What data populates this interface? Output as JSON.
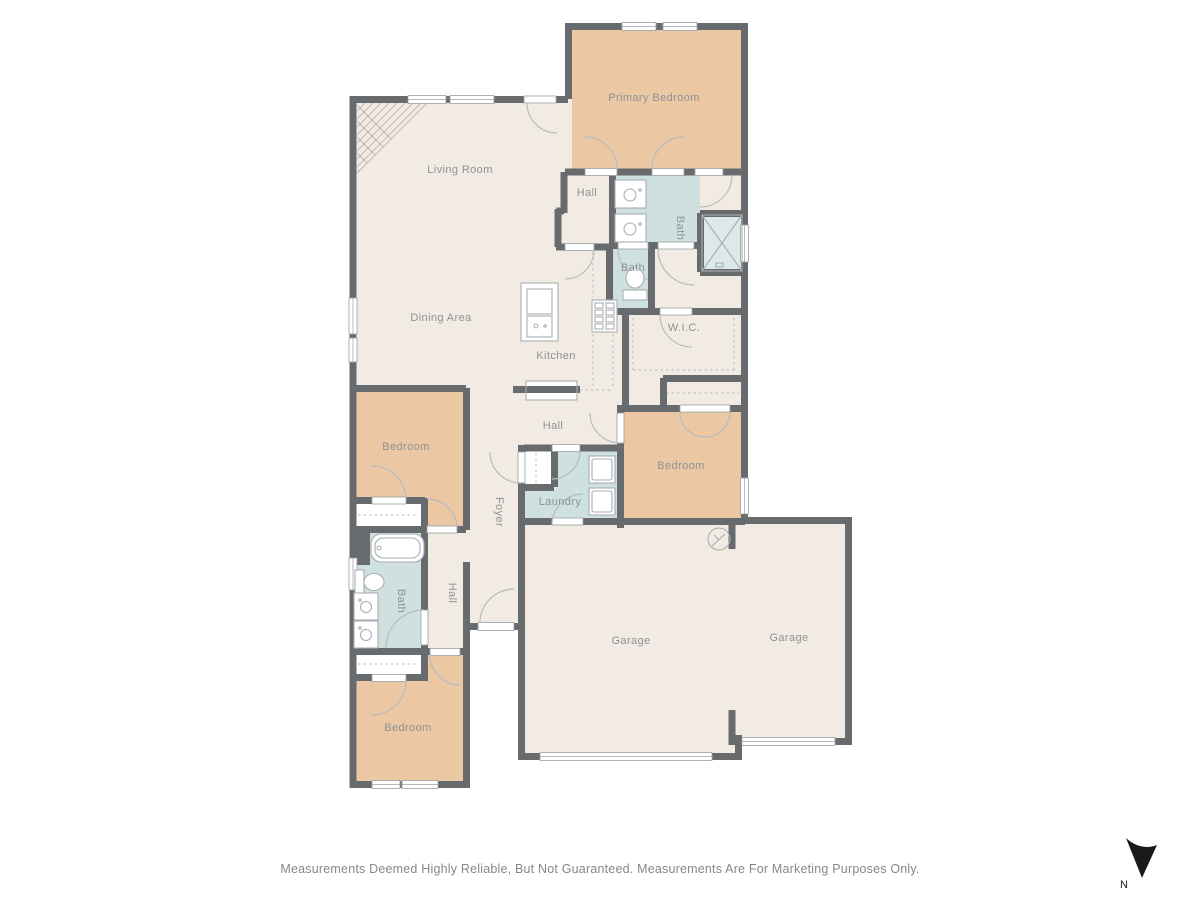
{
  "colors": {
    "background": "#ffffff",
    "floor": "#f2ebe4",
    "bedroom": "#ebc7a3",
    "bath": "#cfe0e0",
    "shower": "#dde9e9",
    "wall": "#676b6e",
    "fixture": "#a9adb0",
    "dash": "#b7bbbd",
    "label": "#8d9296",
    "text": "#83888c",
    "hatch": "#beb4aa",
    "north": "#1a1a1a"
  },
  "rooms": [
    {
      "label": "Primary Bedroom"
    },
    {
      "label": "Living Room"
    },
    {
      "label": "Hall"
    },
    {
      "label": "Bath"
    },
    {
      "label": "Bath"
    },
    {
      "label": "W.I.C."
    },
    {
      "label": "Dining Area"
    },
    {
      "label": "Kitchen"
    },
    {
      "label": "Hall"
    },
    {
      "label": "Bedroom"
    },
    {
      "label": "Bedroom"
    },
    {
      "label": "Laundry"
    },
    {
      "label": "Foyer"
    },
    {
      "label": "Hall"
    },
    {
      "label": "Bath"
    },
    {
      "label": "Bedroom"
    },
    {
      "label": "Garage"
    },
    {
      "label": "Garage"
    }
  ],
  "footer": {
    "disclaimer": "Measurements Deemed Highly Reliable, But Not Guaranteed. Measurements Are For Marketing Purposes Only."
  },
  "compass": {
    "label": "N"
  }
}
